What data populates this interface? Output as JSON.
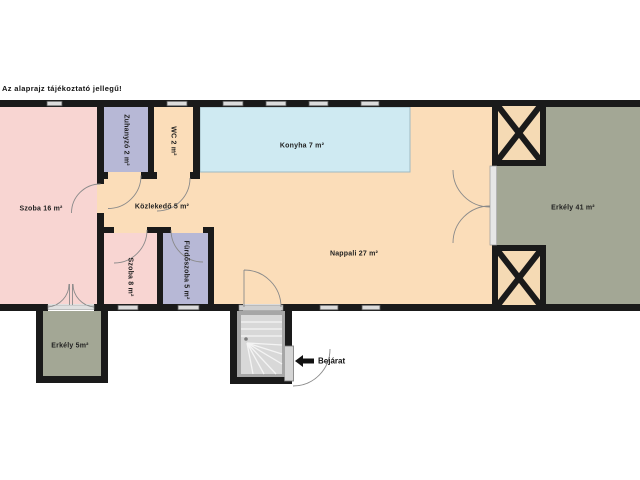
{
  "disclaimer": "Az alaprajz tájékoztató jellegű!",
  "rooms": {
    "szoba16": {
      "label": "Szoba 16 m²"
    },
    "zuhanyzo": {
      "label": "Zuhanyzó 2 m²"
    },
    "wc": {
      "label": "WC 2 m²"
    },
    "konyha": {
      "label": "Konyha 7 m²"
    },
    "kozlekedo": {
      "label": "Közlekedő 5 m²"
    },
    "nappali": {
      "label": "Nappali 27 m²"
    },
    "erkely41": {
      "label": "Erkély 41 m²"
    },
    "szoba8": {
      "label": "Szoba 8 m²"
    },
    "furdoszoba": {
      "label": "Fürdőszoba 5 m²"
    },
    "erkely5": {
      "label": "Erkély 5m²"
    }
  },
  "entrance": {
    "label": "Bejárat",
    "arrow_icon": "left-arrow"
  },
  "colors": {
    "wall": "#1a1a1a",
    "room_pink": "#f8d5d2",
    "room_lavender": "#b7b8d6",
    "room_cream": "#fbddb9",
    "room_blue": "#cfeaf2",
    "balcony_green": "#a3a795",
    "stair_gray": "#d8d8d8",
    "window_gray": "#dcdcdc",
    "text": "#1f1f1f",
    "background": "#ffffff"
  }
}
